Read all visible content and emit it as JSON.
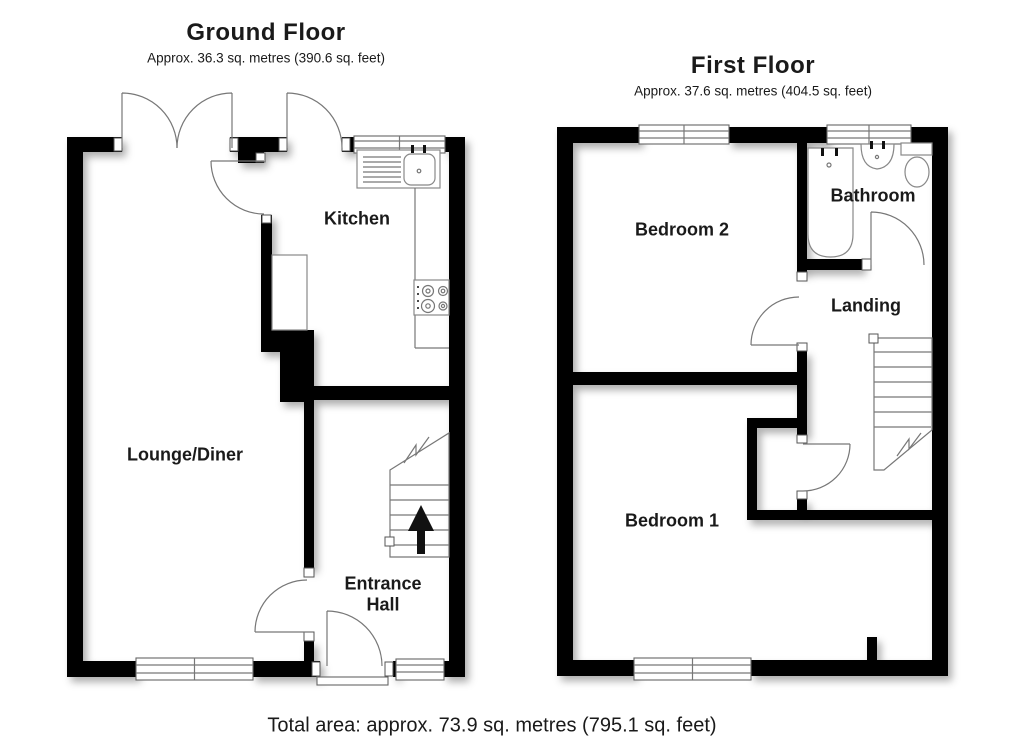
{
  "ground_floor": {
    "title": "Ground Floor",
    "subtitle": "Approx. 36.3 sq. metres (390.6 sq. feet)",
    "rooms": {
      "kitchen": "Kitchen",
      "lounge": "Lounge/Diner",
      "entrance_hall": "Entrance\nHall"
    }
  },
  "first_floor": {
    "title": "First Floor",
    "subtitle": "Approx. 37.6 sq. metres (404.5 sq. feet)",
    "rooms": {
      "bedroom2": "Bedroom 2",
      "bathroom": "Bathroom",
      "landing": "Landing",
      "bedroom1": "Bedroom 1"
    }
  },
  "footer": {
    "total_area": "Total area: approx. 73.9 sq. metres (795.1 sq. feet)"
  },
  "colors": {
    "wall": "#000000",
    "line": "#777777",
    "background": "#ffffff",
    "text": "#1a1a1a"
  }
}
